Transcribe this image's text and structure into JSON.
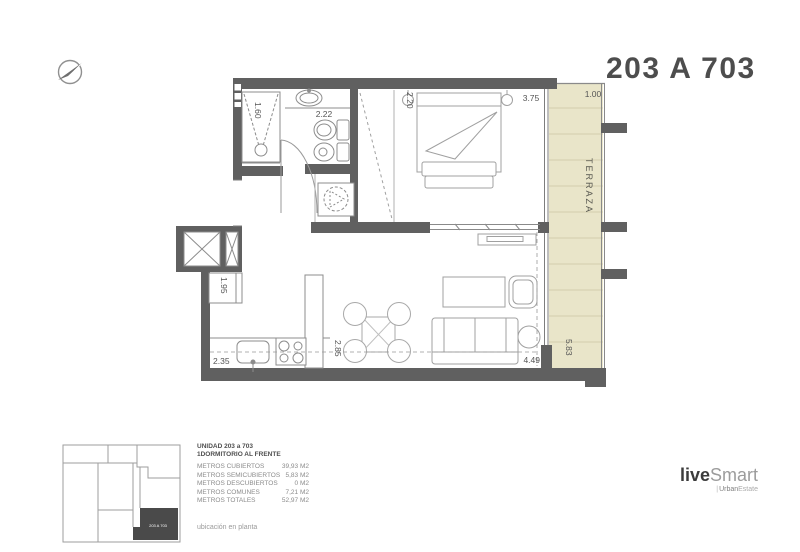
{
  "header": {
    "title": "203 A 703"
  },
  "plan": {
    "rooms": {
      "terrace": "TERRAZA"
    },
    "dimensions": {
      "terrace_width": "1.00",
      "bedroom_width": "3.75",
      "bedroom_depth": "2.20",
      "bath_width": "2.22",
      "shower_width": "1.60",
      "kitchen_fridge": "1.95",
      "kitchen_width": "2.35",
      "kitchen_depth": "2.85",
      "living_width": "4.49",
      "terrace_length": "5.83"
    },
    "colors": {
      "wall": "#606060",
      "terrace_fill": "#e9e5c9",
      "terrace_line": "#d2cdad",
      "highlight": "#4a4a4a"
    }
  },
  "key_plan": {
    "highlight_label": "203 A 703"
  },
  "info_panel": {
    "unit_line": "UNIDAD  203 a 703",
    "type_line": "1DORMITORIO AL FRENTE",
    "rows": [
      {
        "label": "METROS CUBIERTOS",
        "value": "39,93 M2"
      },
      {
        "label": "METROS SEMICUBIERTOS",
        "value": "5,83 M2"
      },
      {
        "label": "METROS DESCUBIERTOS",
        "value": "0 M2"
      },
      {
        "label": "METROS COMUNES",
        "value": "7,21 M2"
      },
      {
        "label": "METROS TOTALES",
        "value": "52,97 M2"
      }
    ],
    "caption": "ubicación en planta"
  },
  "logo": {
    "live": "live",
    "smart": "Smart",
    "separator": "|",
    "sub_bold": "Urban",
    "sub_light": "Estate"
  }
}
